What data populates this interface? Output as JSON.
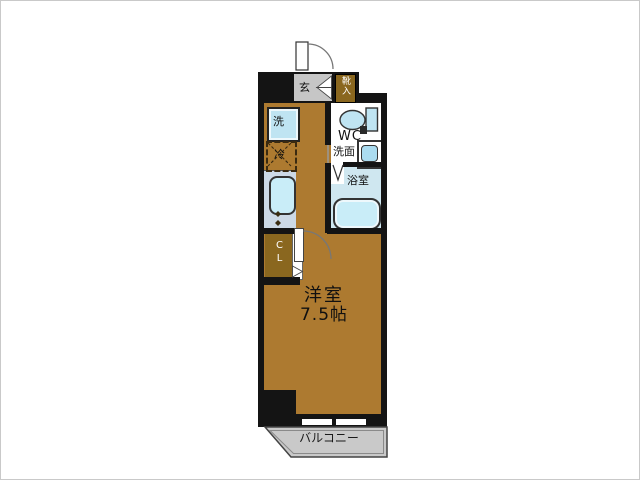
{
  "title": "apartment-floor-plan",
  "labels": {
    "genkan": "玄",
    "shoe_cabinet": "靴入",
    "washer": "洗",
    "fridge": "冷",
    "wc": "WC",
    "washroom": "洗面",
    "bath": "浴室",
    "closet": "CL",
    "room_name": "洋室",
    "room_size": "7.5帖",
    "balcony": "バルコニー"
  },
  "colors": {
    "floor": "#ad7a30",
    "wall": "#141414",
    "cabinet": "#8a671f",
    "genkan": "#c6c6c6",
    "counter": "#ccd9e6",
    "fixture": "#c9edf8",
    "appliance": "#bfe4f2",
    "bath": "#cfe7f0",
    "balcony": "#c9c9c9"
  }
}
